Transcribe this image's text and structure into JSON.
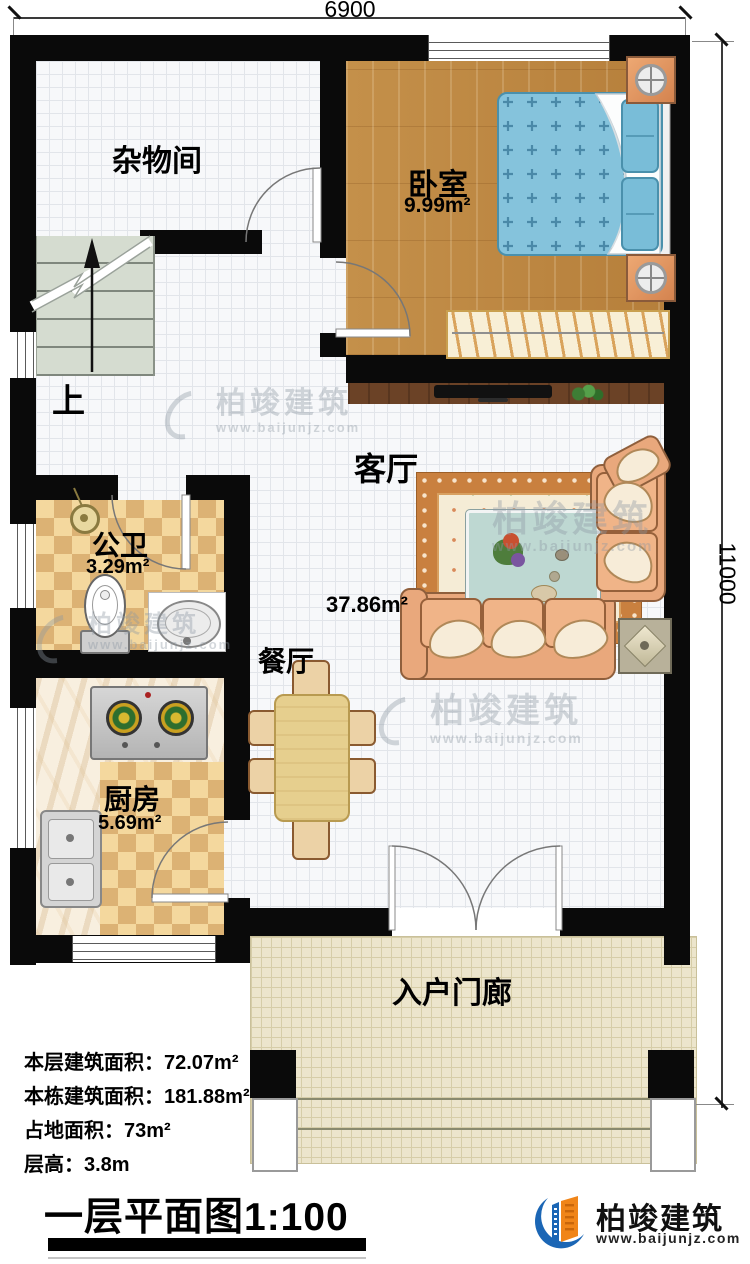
{
  "dimensions": {
    "top": "6900",
    "right": "11000"
  },
  "rooms": {
    "storage": {
      "name": "杂物间"
    },
    "bedroom": {
      "name": "卧室",
      "area": "9.99m²"
    },
    "living": {
      "name": "客厅",
      "area": "37.86m²"
    },
    "dining": {
      "name": "餐厅"
    },
    "bathroom": {
      "name": "公卫",
      "area": "3.29m²"
    },
    "kitchen": {
      "name": "厨房",
      "area": "5.69m²"
    },
    "porch": {
      "name": "入户门廊"
    }
  },
  "stairs": {
    "direction_label": "上"
  },
  "stats": {
    "rows": [
      {
        "label": "本层建筑面积：",
        "value": "72.07m²"
      },
      {
        "label": "本栋建筑面积：",
        "value": "181.88m²"
      },
      {
        "label": "占地面积：",
        "value": "73m²"
      },
      {
        "label": "层高：",
        "value": "3.8m"
      }
    ]
  },
  "title": "一层平面图1:100",
  "brand": {
    "name": "柏竣建筑",
    "url": "www.baijunjz.com"
  },
  "watermark": {
    "name": "柏竣建筑",
    "url": "www.baijunjz.com"
  },
  "colors": {
    "wall": "#0a0a0a",
    "wood": "#c08a44",
    "brand_blue": "#1b66b5",
    "brand_orange": "#f08519"
  }
}
